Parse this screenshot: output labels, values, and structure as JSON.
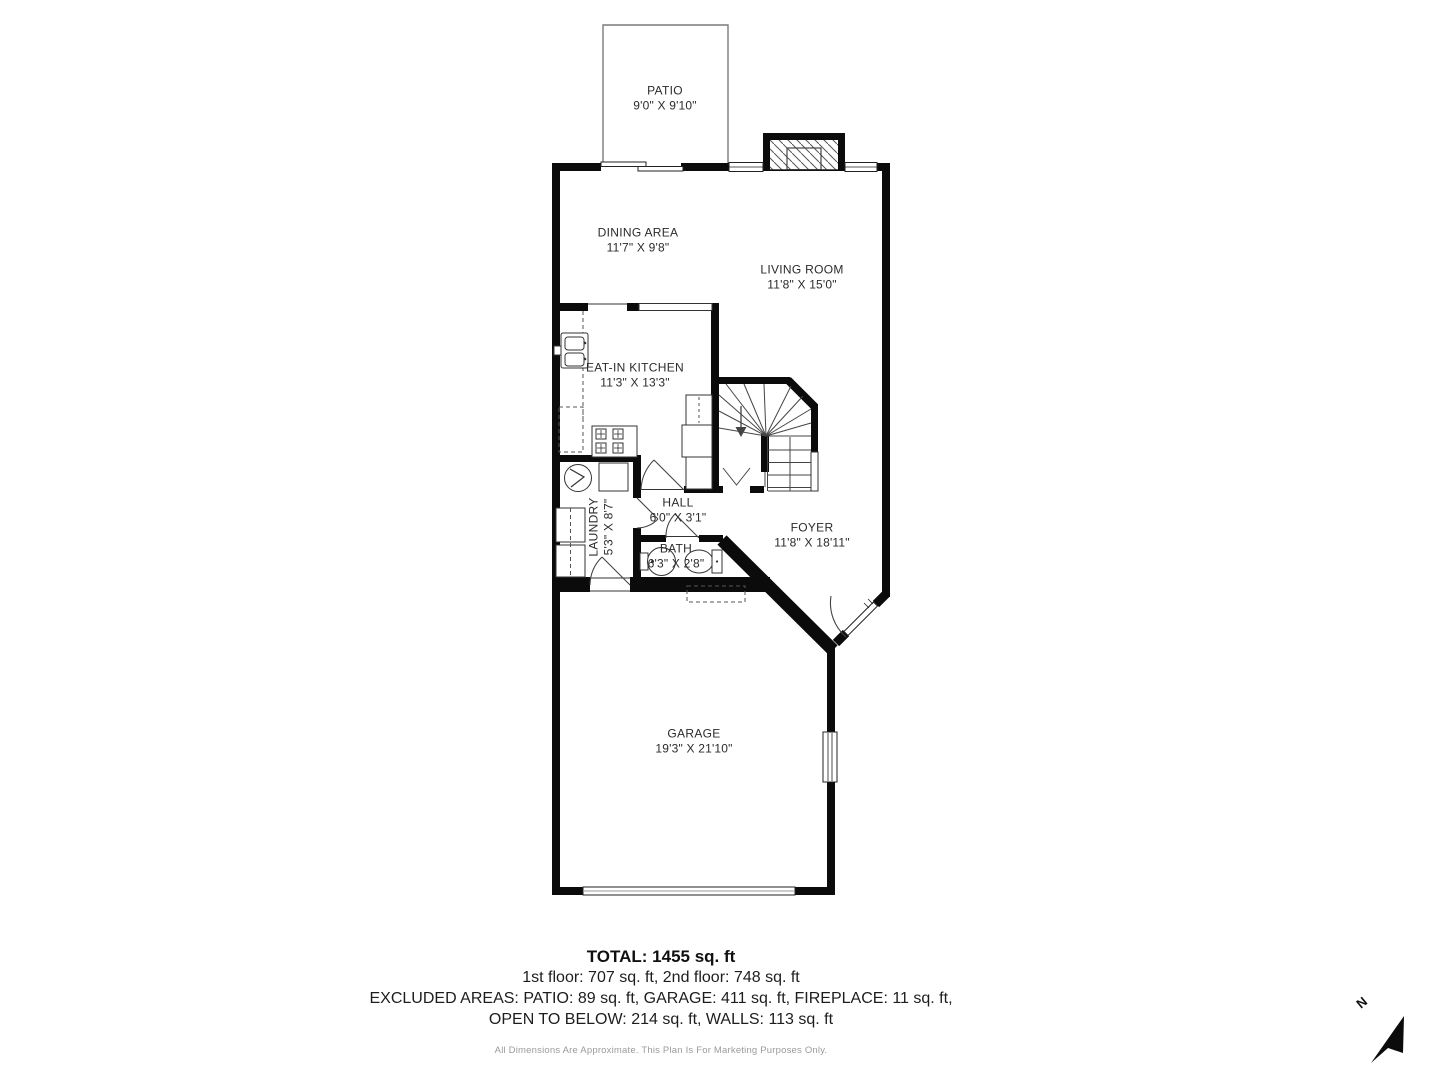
{
  "plan": {
    "rooms": {
      "patio": {
        "name": "PATIO",
        "dims": "9'0\" X 9'10\""
      },
      "dining": {
        "name": "DINING AREA",
        "dims": "11'7\" X 9'8\""
      },
      "living": {
        "name": "LIVING ROOM",
        "dims": "11'8\" X 15'0\""
      },
      "kitchen": {
        "name": "EAT-IN KITCHEN",
        "dims": "11'3\" X 13'3\""
      },
      "laundry": {
        "name": "LAUNDRY",
        "dims": "5'3\" X 8'7\""
      },
      "hall": {
        "name": "HALL",
        "dims": "6'0\" X 3'1\""
      },
      "bath": {
        "name": "BATH",
        "dims": "6'3\" X 2'8\""
      },
      "foyer": {
        "name": "FOYER",
        "dims": "11'8\" X 18'11\""
      },
      "garage": {
        "name": "GARAGE",
        "dims": "19'3\" X 21'10\""
      }
    },
    "north_label": "N"
  },
  "summary": {
    "total": "TOTAL: 1455 sq. ft",
    "floors": "1st floor: 707 sq. ft, 2nd floor: 748 sq. ft",
    "excluded_line1": "EXCLUDED AREAS: PATIO: 89 sq. ft, GARAGE: 411 sq. ft, FIREPLACE: 11 sq. ft,",
    "excluded_line2": "OPEN TO BELOW: 214 sq. ft, WALLS: 113 sq. ft",
    "disclaimer": "All Dimensions Are Approximate. This Plan Is For Marketing Purposes Only."
  },
  "colors": {
    "wall": "#0b0b0b",
    "thin_line": "#444444",
    "text": "#2b2b2b",
    "muted": "#9b9b9b"
  }
}
